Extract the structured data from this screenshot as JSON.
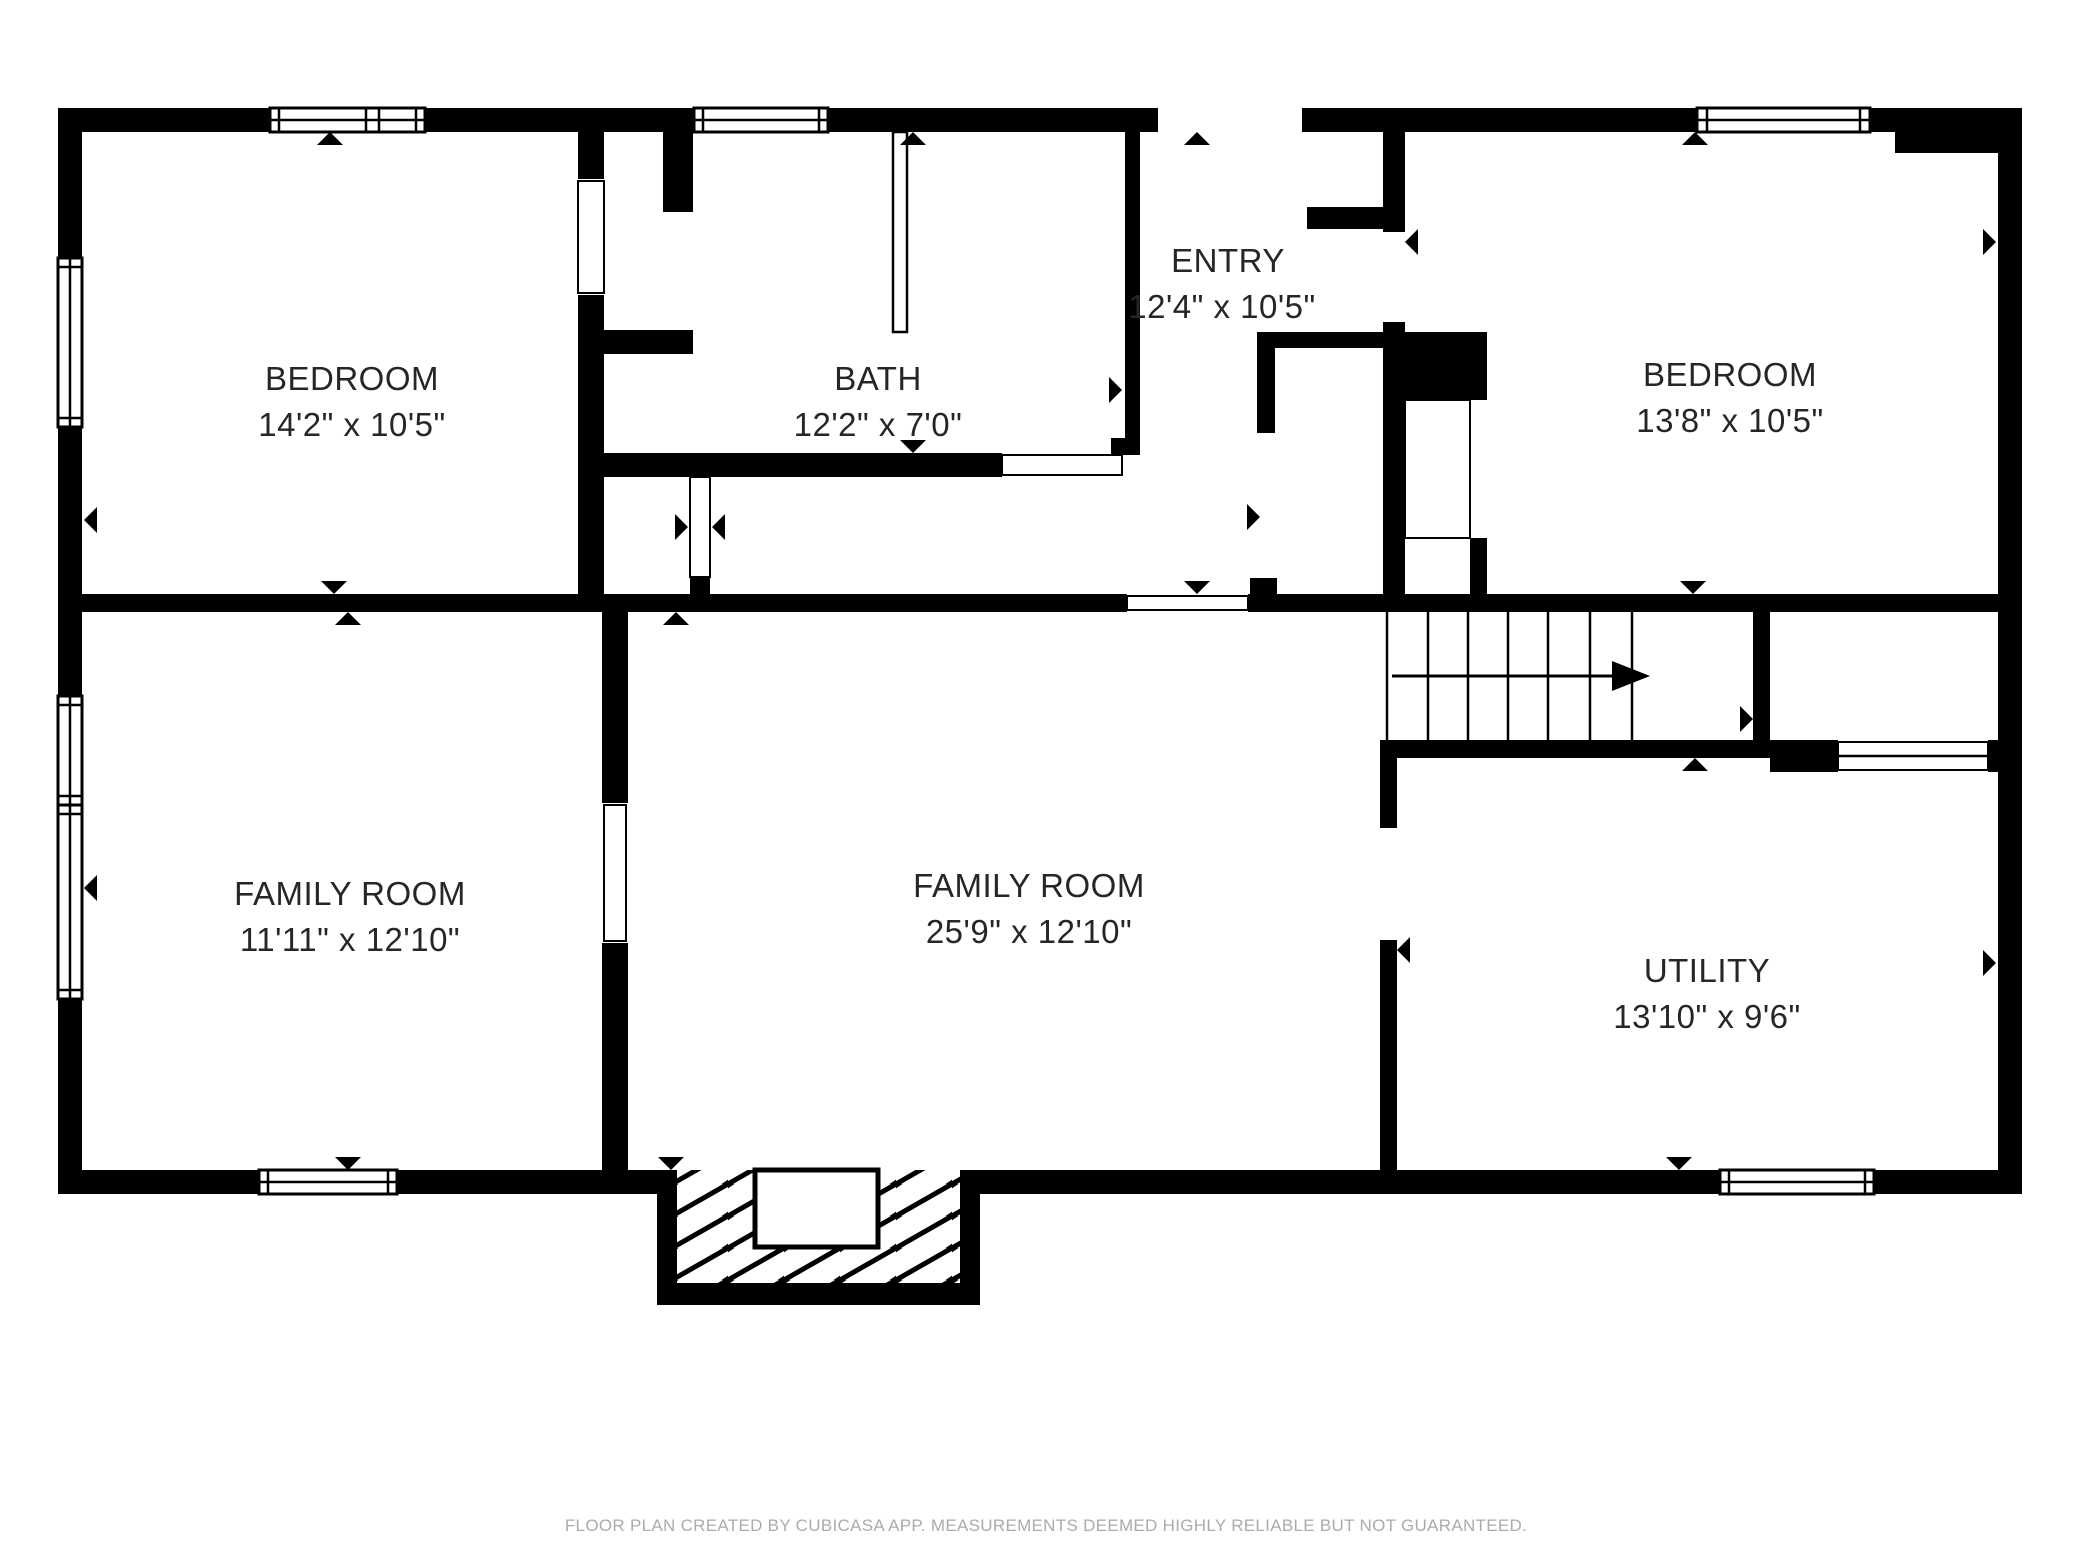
{
  "rooms": [
    {
      "id": "bedroom-1",
      "name": "BEDROOM",
      "dimensions": "14'2\" x 10'5\""
    },
    {
      "id": "bath",
      "name": "BATH",
      "dimensions": "12'2\" x 7'0\""
    },
    {
      "id": "entry",
      "name": "ENTRY",
      "dimensions": "12'4\" x 10'5\""
    },
    {
      "id": "bedroom-2",
      "name": "BEDROOM",
      "dimensions": "13'8\" x 10'5\""
    },
    {
      "id": "family-room-1",
      "name": "FAMILY ROOM",
      "dimensions": "11'11\" x 12'10\""
    },
    {
      "id": "family-room-2",
      "name": "FAMILY ROOM",
      "dimensions": "25'9\" x 12'10\""
    },
    {
      "id": "utility",
      "name": "UTILITY",
      "dimensions": "13'10\" x 9'6\""
    }
  ],
  "footer": {
    "disclaimer": "FLOOR PLAN CREATED BY CUBICASA APP. MEASUREMENTS DEEMED HIGHLY RELIABLE BUT NOT GUARANTEED."
  },
  "colors": {
    "wall": "#000000",
    "background": "#ffffff",
    "room_text": "#262626",
    "footer_text": "#ababab"
  }
}
